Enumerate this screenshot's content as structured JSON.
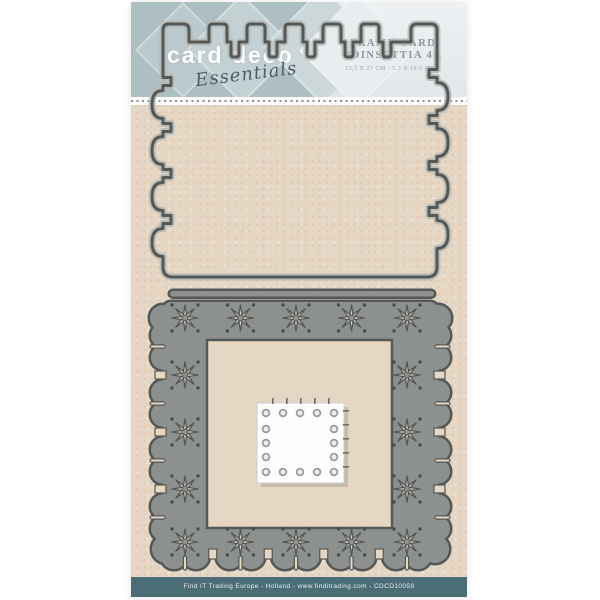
{
  "brand": {
    "name": "card deco",
    "tagline": "Essentials"
  },
  "header": {
    "title_line1": "FRAME CARD",
    "title_line2": "POINSETTIA 4K",
    "dimensions": "13,5 X 27 CM - 5.3 X 10.6 INCH"
  },
  "footer": {
    "text": "Find IT Trading Europe - Holland - www.finditrading.com - CDCD10059"
  },
  "dies": {
    "top_die": "stamp-edge-rectangle-die",
    "frame_die": "poinsettia-star-frame-die",
    "mini_die": "dotted-square-die"
  },
  "colors": {
    "kraft_background": "#e6d6c4",
    "die_fill": "#8c918f",
    "die_outline": "#545856",
    "die_halo": "#b3b7b4",
    "dot_engraving": "#494d4b",
    "footer_band": "#4b6e76",
    "header_band": "#aebfc4",
    "header_background": "#eceff1",
    "title_text": "#8a96a5",
    "logo_text": "#ffffff",
    "script_text": "#4e5d68",
    "mini_square": "#fdfdfd"
  }
}
